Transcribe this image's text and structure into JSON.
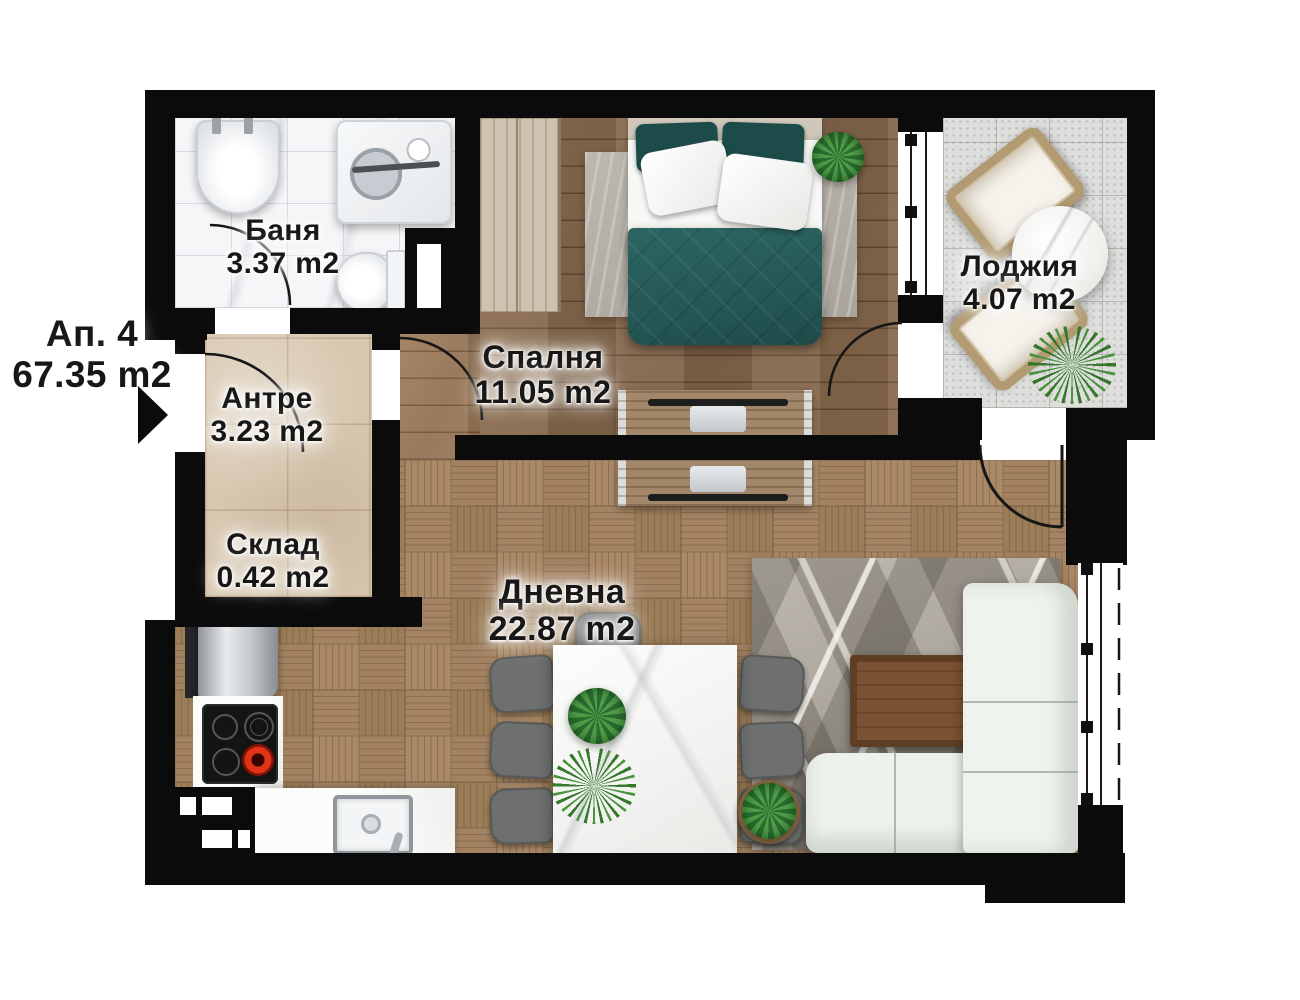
{
  "plan": {
    "apartment": {
      "label": "Ап. 4",
      "area": "67.35 m2"
    },
    "rooms": [
      {
        "key": "bathroom",
        "name": "Баня",
        "area": "3.37 m2"
      },
      {
        "key": "hallway",
        "name": "Антре",
        "area": "3.23 m2"
      },
      {
        "key": "storage",
        "name": "Склад",
        "area": "0.42 m2"
      },
      {
        "key": "bedroom",
        "name": "Спалня",
        "area": "11.05 m2"
      },
      {
        "key": "loggia",
        "name": "Лоджия",
        "area": "4.07 m2"
      },
      {
        "key": "living",
        "name": "Дневна",
        "area": "22.87 m2"
      }
    ],
    "icons": {
      "entrance_arrow": "triangle-right"
    },
    "palette": {
      "wall": "#0b0b0b",
      "bathroom_floor": "#f6f6f8",
      "hall_floor": "#d8c8b1",
      "bedroom_floor": "#8a6c4e",
      "living_floor": "#9e7c59",
      "loggia_floor": "#dededc",
      "bed_accent": "#27605d",
      "sofa": "#edf2ec",
      "label_text": "#171717"
    }
  }
}
